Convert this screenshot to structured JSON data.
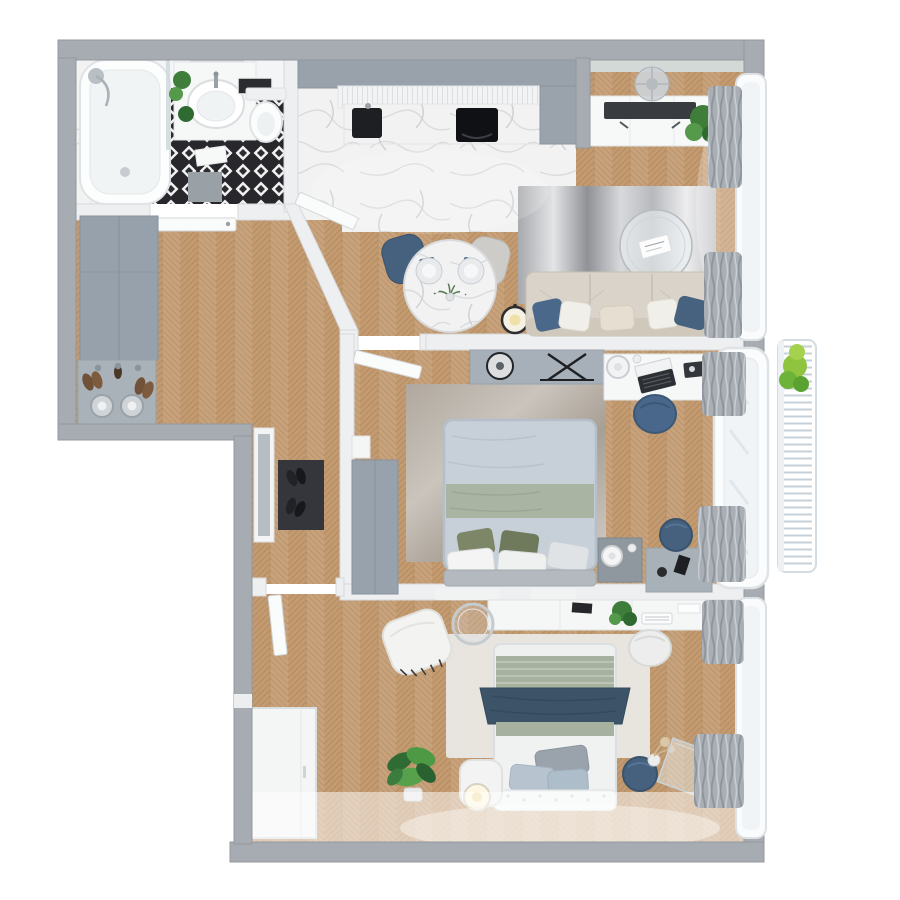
{
  "meta": {
    "title": "3D floor plan — two-bedroom apartment, top-down render",
    "canvas": {
      "width": 900,
      "height": 900
    },
    "style": "photoreal 3D render, no text labels"
  },
  "palette": {
    "page_bg": "#ffffff",
    "wall_exterior": "#a6acb2",
    "wall_exterior_edge": "#94999f",
    "wall_interior": "#edeff1",
    "wall_interior_edge": "#d6d9dc",
    "wall_paint_teal": "#d2d9d6",
    "wood_base": "#c49b70",
    "wood_line": "#a9825a",
    "wood_highlight": "#ffffff",
    "marble_base": "#f2f2f3",
    "marble_vein": "#d7d9db",
    "tile_dark": "#27272c",
    "tile_light": "#f2f2f2",
    "cabinet_gray": "#97a1ab",
    "cabinet_gray_dark": "#86929c",
    "white_furniture": "#f6f7f7",
    "furniture_stroke": "#e0e3e6",
    "accent_navy": "#45617e",
    "accent_navy_dark": "#3a536d",
    "sofa_beige": "#d9d3c9",
    "sofa_beige_dark": "#cfc8bb",
    "duvet_bluegray": "#c7d0d9",
    "sage_green": "#a9b4a2",
    "navy_throw": "#3d5468",
    "olive_pillow": "#7d8767",
    "rug_white": "#e9e7e3",
    "rug_living_a": "#a7a9ad",
    "rug_living_b": "#e3e4e6",
    "rug_living_c": "#8f9196",
    "rug_mid_a": "#b0a89e",
    "rug_mid_b": "#cac4bd",
    "curtain_gray": "#a9afb5",
    "curtain_line": "#8e959c",
    "sheer_white": "#f0f4f7",
    "mat_dark": "#34363b",
    "plant_green": "#4e9a44",
    "plant_green_dark": "#2f6b33",
    "plant_green_light": "#8fc43f",
    "lamp_glow": "#f0dfa6",
    "metal_gray": "#b9c0c5",
    "appliance_black": "#1d1f23",
    "balcony_slat": "#c6d0d9",
    "headboard_gray": "#b3b9be",
    "shoe_brown": "#6f5237"
  },
  "rooms": [
    {
      "id": "bathroom",
      "label": "bathroom",
      "furniture": [
        "bathtub",
        "shower-head",
        "glass-panel",
        "vanity-with-basin",
        "plant",
        "toilet",
        "wall-art-tray",
        "gray-bath-mat",
        "white-towel"
      ]
    },
    {
      "id": "hallway",
      "label": "hallway",
      "furniture": [
        "gray-wardrobe",
        "shoe-bench",
        "shoes",
        "metal-poufs",
        "dark-door-mat",
        "leaning-mirror",
        "open-doors"
      ]
    },
    {
      "id": "kitchen",
      "label": "kitchen-dining",
      "furniture": [
        "upper-cabinets",
        "ribbed-counter",
        "black-sink",
        "induction-cooktop",
        "tall-cabinet",
        "round-marble-dining-table",
        "navy-chair",
        "gray-chair",
        "place-settings",
        "flower-vase",
        "candle-lantern"
      ]
    },
    {
      "id": "living",
      "label": "living-room",
      "furniture": [
        "tv-console",
        "tv",
        "plant",
        "ceiling-light",
        "abstract-gray-rug",
        "round-glass-coffee-table",
        "magazine",
        "beige-sofa",
        "throw-pillows",
        "gray-drapes",
        "window"
      ]
    },
    {
      "id": "bedroom_main",
      "label": "main-bedroom",
      "furniture": [
        "double-bed",
        "sage-runner",
        "olive-and-white-pillows",
        "headboard",
        "bedside-mats",
        "gray-beige-rug",
        "gray-wardrobe",
        "console-shelf-with-decor",
        "desk",
        "laptop",
        "desk-lamp",
        "navy-desk-chair",
        "nightstand-with-lamp",
        "side-table",
        "navy-pouf",
        "gray-drapes",
        "bay-window"
      ]
    },
    {
      "id": "bedroom_second",
      "label": "second-bedroom",
      "furniture": [
        "single-bed",
        "navy-throw",
        "striped-sage-duvet",
        "tufted-headboard",
        "white-rug",
        "wall-console-desk",
        "keyboard",
        "plant-on-desk",
        "white-armchair-with-fringe-blanket",
        "round-leaning-mirror",
        "white-desk-chair",
        "white-pouf",
        "wire-floor-lamp",
        "large-plant",
        "navy-pouf",
        "pampas-vase",
        "acrylic-side-table",
        "white-wardrobe",
        "gray-drapes",
        "window"
      ]
    },
    {
      "id": "balcony",
      "label": "balcony",
      "furniture": [
        "slatted-railing",
        "plant"
      ]
    }
  ],
  "windows": {
    "count": 3,
    "side": "right",
    "frame_color": "#fafbfc"
  }
}
